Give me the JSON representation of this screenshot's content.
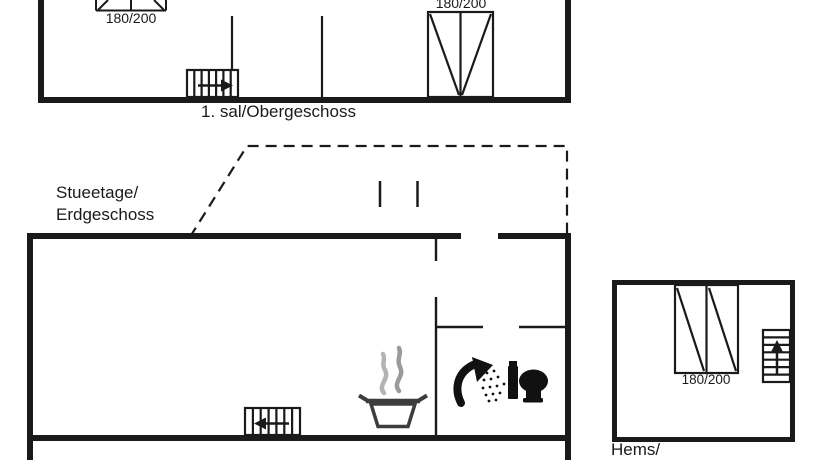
{
  "colors": {
    "line": "#1a1a1a",
    "background": "#ffffff",
    "pot_outline": "#3d3d3d",
    "steam_light": "#b3b3b3",
    "steam_dark": "#9a9a9a",
    "fixture_black": "#111111"
  },
  "floors": {
    "upper": {
      "label": "1. sal/Obergeschoss",
      "beds": [
        {
          "size": "180/200"
        },
        {
          "size": "180/200"
        }
      ],
      "icons": [
        "staircase-with-right-arrow",
        "double-bed",
        "double-bed"
      ]
    },
    "ground": {
      "label_line1": "Stueetage/",
      "label_line2": "Erdgeschoss",
      "icons": [
        "staircase-with-left-arrow",
        "cooking-pot-with-steam",
        "shower-head",
        "toilet"
      ],
      "roof_outline": "dashed"
    },
    "loft": {
      "label": "Hems/",
      "beds": [
        {
          "size": "180/200"
        }
      ],
      "icons": [
        "staircase-with-up-arrow",
        "double-bed"
      ]
    }
  }
}
